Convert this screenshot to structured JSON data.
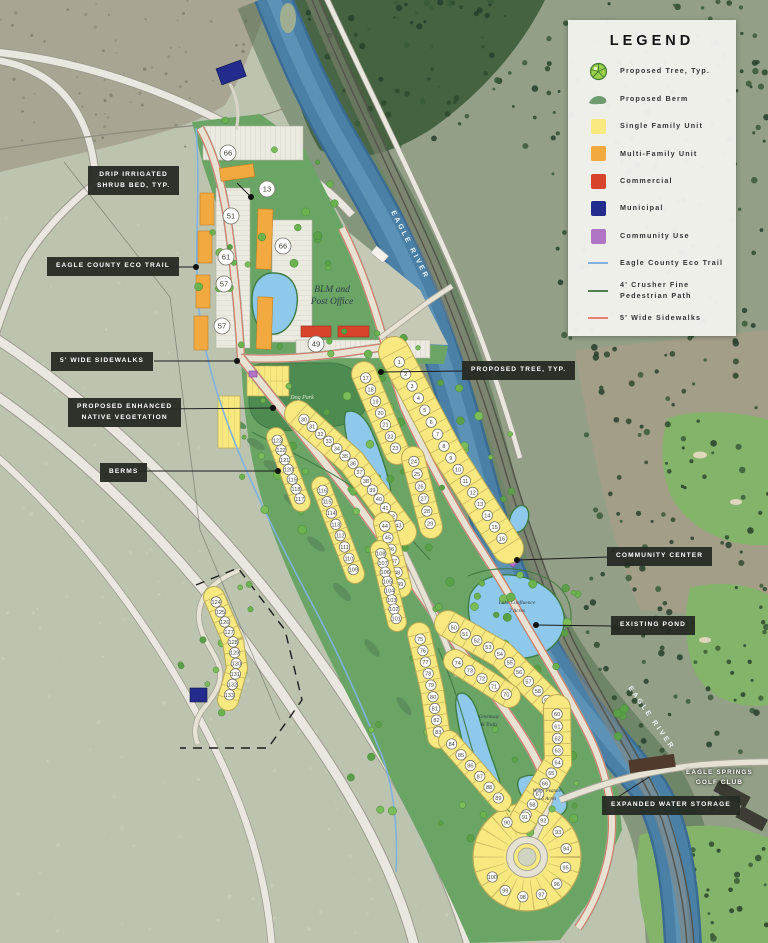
{
  "legend": {
    "title": "LEGEND",
    "items": [
      {
        "icon": "tree",
        "label": "Proposed Tree, Typ."
      },
      {
        "icon": "berm",
        "label": "Proposed Berm"
      },
      {
        "icon": "swatch",
        "color": "#F7E97F",
        "label": "Single Family Unit"
      },
      {
        "icon": "swatch",
        "color": "#F2A93F",
        "label": "Multi-Family Unit"
      },
      {
        "icon": "swatch",
        "color": "#D8432C",
        "label": "Commercial"
      },
      {
        "icon": "swatch",
        "color": "#232C8C",
        "label": "Municipal"
      },
      {
        "icon": "swatch",
        "color": "#B175C6",
        "label": "Community Use"
      },
      {
        "icon": "line",
        "color": "#7FB2E0",
        "label": "Eagle County Eco Trail"
      },
      {
        "icon": "line",
        "color": "#4E7F4E",
        "label": "4' Crusher Fine Pedestrian Path"
      },
      {
        "icon": "line",
        "color": "#E8836D",
        "label": "5' Wide Sidewalks"
      }
    ]
  },
  "callouts": [
    {
      "id": "drip",
      "lines": [
        "DRIP IRRIGATED",
        "SHRUB BED, TYP."
      ]
    },
    {
      "id": "ecotrail",
      "lines": [
        "EAGLE COUNTY ECO TRAIL"
      ]
    },
    {
      "id": "sidewalks",
      "lines": [
        "5' WIDE SIDEWALKS"
      ]
    },
    {
      "id": "vegetation",
      "lines": [
        "PROPOSED ENHANCED",
        "NATIVE VEGETATION"
      ]
    },
    {
      "id": "berms",
      "lines": [
        "BERMS"
      ]
    },
    {
      "id": "tree",
      "lines": [
        "PROPOSED TREE, TYP."
      ]
    },
    {
      "id": "community",
      "lines": [
        "COMMUNITY CENTER"
      ]
    },
    {
      "id": "pond",
      "lines": [
        "EXISTING POND"
      ]
    },
    {
      "id": "storage",
      "lines": [
        "EXPANDED WATER STORAGE"
      ]
    },
    {
      "id": "golf",
      "lines": [
        "EAGLE SPRINGS",
        "GOLF CLUB"
      ],
      "plain": true
    }
  ],
  "map": {
    "labels": {
      "river": "EAGLE RIVER",
      "blm": [
        "BLM and",
        "Post Office"
      ],
      "dog_park": "Dog Park",
      "lake": [
        "Lake Confluence",
        "2 Acres"
      ],
      "greenway": [
        "Greenway",
        "& Trails"
      ],
      "water_feature": [
        "Water Feature",
        "1.5 Acres"
      ]
    },
    "lot_rows": [
      {
        "id": "s1",
        "numbers": [
          1,
          2,
          3,
          4,
          5,
          6,
          7,
          8,
          9,
          10,
          11,
          12,
          13,
          14,
          15,
          16
        ]
      },
      {
        "id": "s2",
        "numbers": [
          17,
          18,
          19,
          20,
          21,
          22,
          23
        ]
      },
      {
        "id": "s3",
        "numbers": [
          24,
          25,
          26,
          27,
          28,
          29
        ]
      },
      {
        "id": "s4",
        "numbers": [
          30,
          31,
          32,
          33,
          34,
          35,
          36,
          37,
          38,
          39,
          40,
          41,
          42,
          43
        ]
      },
      {
        "id": "s5",
        "numbers": [
          44,
          45,
          46,
          47,
          48,
          49
        ]
      },
      {
        "id": "s6",
        "numbers": [
          50,
          51,
          52,
          53,
          54,
          55,
          56,
          57,
          58,
          59
        ]
      },
      {
        "id": "s7",
        "numbers": [
          60,
          61,
          62,
          63,
          64,
          65,
          66,
          67,
          68,
          69
        ]
      },
      {
        "id": "s8",
        "numbers": [
          70,
          71,
          72,
          73,
          74
        ]
      },
      {
        "id": "s9",
        "numbers": [
          75,
          76,
          77,
          78,
          79,
          80,
          81,
          82,
          83
        ]
      },
      {
        "id": "s10",
        "numbers": [
          84,
          85,
          86,
          87,
          88,
          89
        ]
      },
      {
        "id": "s11",
        "numbers": [
          90,
          91,
          92,
          93,
          94,
          95,
          96,
          97,
          98,
          99,
          100
        ]
      },
      {
        "id": "s12",
        "numbers": [
          108,
          107,
          106,
          105,
          104,
          103,
          102,
          101
        ]
      },
      {
        "id": "s13",
        "numbers": [
          116,
          115,
          114,
          113,
          112,
          111,
          110,
          109
        ]
      },
      {
        "id": "s14",
        "numbers": [
          123,
          122,
          121,
          120,
          119,
          118,
          117
        ]
      },
      {
        "id": "s15",
        "numbers": [
          124,
          125,
          126,
          127,
          128,
          129,
          130,
          131,
          132,
          133
        ]
      }
    ],
    "unit_counts": [
      66,
      13,
      51,
      66,
      61,
      57,
      57,
      49
    ]
  },
  "colors": {
    "single_family": "#F7E97F",
    "multi_family": "#F2A93F",
    "commercial": "#D8432C",
    "municipal": "#232C8C",
    "community_use": "#B175C6",
    "eco_trail": "#7FB2E0",
    "crusher_path": "#4E7F4E",
    "sidewalk": "#E8836D",
    "river": "#4A80A6",
    "dev_green": "#6BA566",
    "park_green": "#4E8B51",
    "pond_blue": "#8EC9EC"
  }
}
